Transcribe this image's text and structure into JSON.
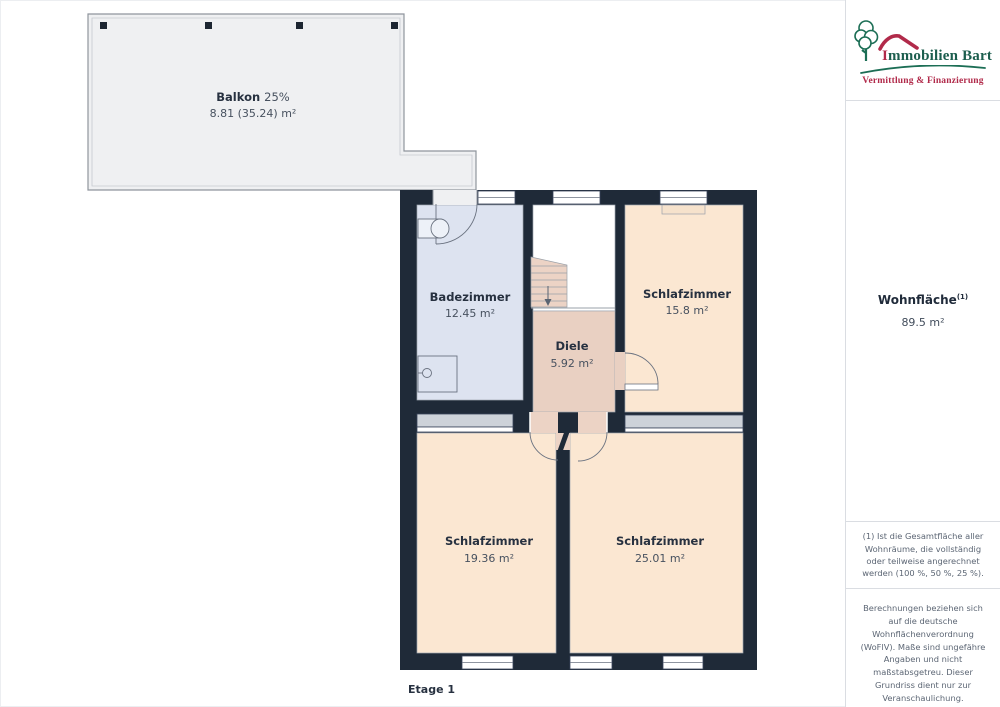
{
  "plan": {
    "floor_label": "Etage 1",
    "rooms": {
      "balkon": {
        "name": "Balkon",
        "suffix": "25%",
        "area": "8.81 (35.24) m²"
      },
      "badezimmer": {
        "name": "Badezimmer",
        "area": "12.45 m²"
      },
      "schlafzimmer1": {
        "name": "Schlafzimmer",
        "area": "15.8 m²"
      },
      "diele": {
        "name": "Diele",
        "area": "5.92 m²"
      },
      "schlafzimmer2": {
        "name": "Schlafzimmer",
        "area": "19.36 m²"
      },
      "schlafzimmer3": {
        "name": "Schlafzimmer",
        "area": "25.01 m²"
      }
    }
  },
  "sidebar": {
    "logo": {
      "brand": "Immobilien Bart",
      "tagline": "Vermittlung & Finanzierung"
    },
    "summary": {
      "label": "Wohnfläche",
      "sup": "(1)",
      "value": "89.5 m²"
    },
    "footnote": "(1) Ist die Gesamtfläche aller Wohnräume, die vollständig oder teilweise angerechnet werden (100 %, 50 %, 25 %).",
    "disclaimer": "Berechnungen beziehen sich auf die deutsche Wohnflächenverordnung (WoFlV). Maße sind ungefähre Angaben und nicht maßstabsgetreu. Dieser Grundriss dient nur zur Veranschaulichung.",
    "vendor": {
      "name": "GIRAFFE",
      "number": "360"
    }
  },
  "colors": {
    "wall": "#1f2a38",
    "bathroom_fill": "#dde3f0",
    "bedroom_fill": "#fbe7d2",
    "hall_fill": "#e9d0c2",
    "balcony_fill": "#eff0f2",
    "brand_green": "#1c5e4e",
    "brand_red": "#b12a4a"
  }
}
